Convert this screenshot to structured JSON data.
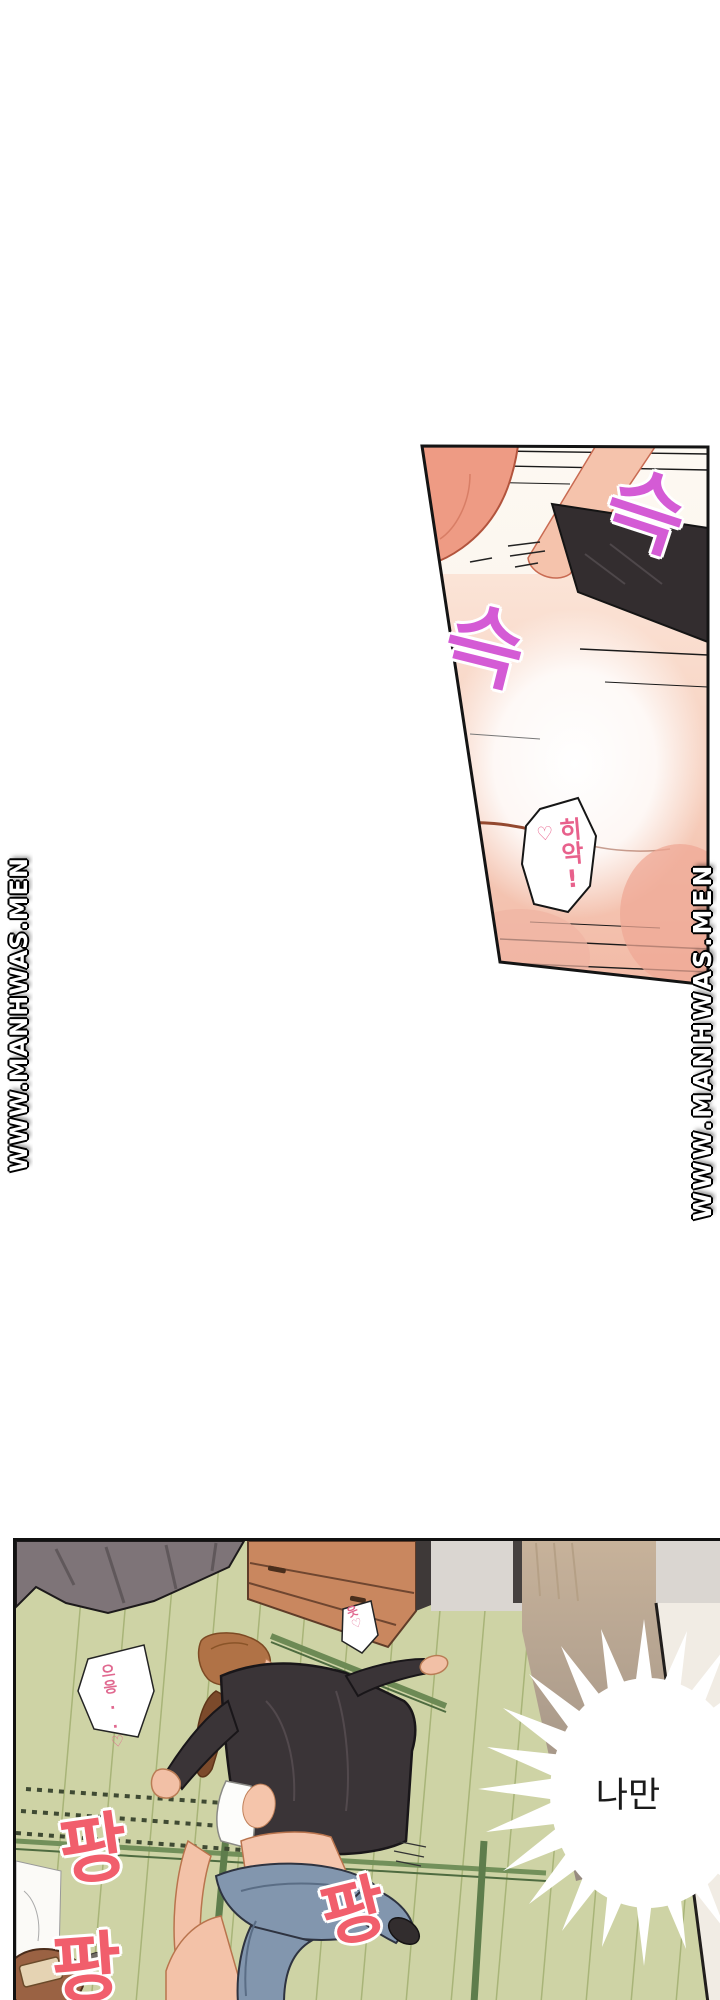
{
  "page": {
    "width": 720,
    "height": 2000,
    "background": "#ffffff"
  },
  "watermark": {
    "text": "WWW.MANHWAS.MEN",
    "text_color": "#ffffff",
    "outline_color": "#000000"
  },
  "top_panel": {
    "sfx_slide_1": "슥",
    "sfx_slide_2": "슥",
    "sfx_color": "#d45bd5",
    "gasp_bubble": {
      "text": "히악!",
      "heart": "♡",
      "text_color": "#e8618c"
    }
  },
  "bottom_panel": {
    "note_left": "으응..♡",
    "note_right": "읏♡",
    "note_color": "#e0688f",
    "sfx_pang": [
      "팡",
      "팡",
      "팡"
    ],
    "sfx_pang_color": "#f15e6c",
    "speech_bubble": {
      "text": "나만",
      "text_color": "#1a1a1a"
    }
  },
  "art_colors": {
    "skin": "#f3c2a8",
    "skin_shadow": "#ee9b84",
    "dark_clothing": "#3a3437",
    "tatami": "#ced3a5",
    "tatami_line": "#a8b478",
    "tatami_band": "#5e7d4c",
    "cabinet_wood": "#c9875f",
    "curtain": "#7e7478",
    "jeans": "#8296ae",
    "hair_man": "#b07246",
    "hair_woman": "#7c4a2b",
    "wall_light": "#f1ece4",
    "wall_tan": "#c7b29a"
  }
}
